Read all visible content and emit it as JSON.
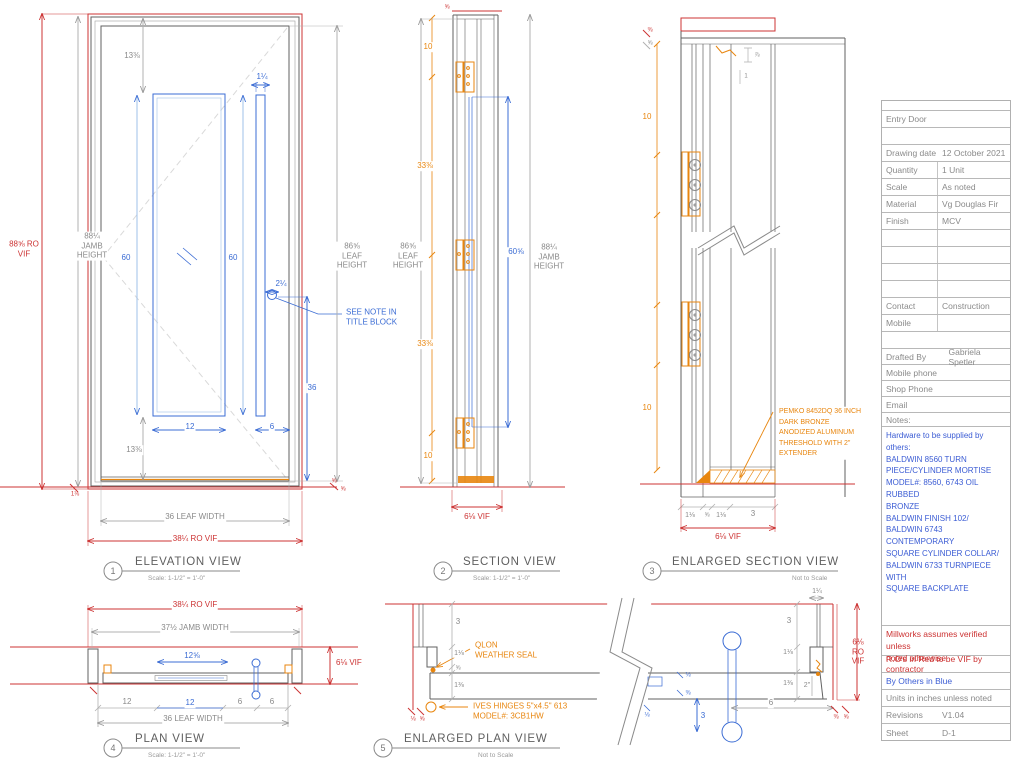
{
  "colors": {
    "red": "#cc3333",
    "blue": "#3b6cd4",
    "orange": "#e8860f",
    "gray": "#8a8a8a",
    "line": "#606060"
  },
  "views": {
    "elevation": {
      "number": "1",
      "title": "ELEVATION VIEW",
      "scale": "Scale: 1-1/2\" = 1'-0\"",
      "dims": {
        "ro_height": "88⅝ RO\nVIF",
        "jamb_height": "88¼\nJAMB\nHEIGHT",
        "glass_top": "13⅜",
        "pull_width": "1¼",
        "glass_height": "60",
        "pull_height": "60",
        "pull_edge": "2¼",
        "pull_bottom": "36",
        "glass_width": "12",
        "pull_gap": "6",
        "glass_bottom": "13⅜",
        "leaf_height": "86⅝\nLEAF\nHEIGHT",
        "leaf_width": "36 LEAF WIDTH",
        "ro_width": "38¼ RO VIF",
        "threshold_left": "1⅛",
        "threshold_right_a": "⅝",
        "threshold_right_b": "⅝"
      },
      "note": "SEE NOTE IN\nTITLE BLOCK"
    },
    "section": {
      "number": "2",
      "title": "SECTION VIEW",
      "scale": "Scale: 1-1/2\" = 1'-0\"",
      "dims": {
        "leaf_height": "86⅝\nLEAF\nHEIGHT",
        "top": "10",
        "upper": "33⅜",
        "lower": "33⅜",
        "bottom": "10",
        "glass": "60⅝",
        "jamb_height": "88¼\nJAMB\nHEIGHT",
        "width_vif": "6⅛ VIF",
        "head": "⅝"
      }
    },
    "enlarged_section": {
      "number": "3",
      "title": "ENLARGED SECTION VIEW",
      "scale": "Not to Scale",
      "dims": {
        "top": "10",
        "bottom": "10",
        "b1": "1⅛",
        "b2": "⅝",
        "b3": "1⅛",
        "b4": "3",
        "width_vif": "6⅛ VIF",
        "tl1": "⅜",
        "tl2": "⅝",
        "tr1": "⅞",
        "tr2": "1"
      },
      "note": "PEMKO 8452DQ 36 INCH\nDARK BRONZE\nANODIZED ALUMINUM\nTHRESHOLD WITH 2\"\nEXTENDER"
    },
    "plan": {
      "number": "4",
      "title": "PLAN VIEW",
      "scale": "Scale: 1-1/2\" = 1'-0\"",
      "dims": {
        "ro_width": "38¼ RO VIF",
        "jamb_width": "37½ JAMB WIDTH",
        "glass": "12⅝",
        "depth_vif": "6⅛ VIF",
        "left": "12",
        "glass_b": "12",
        "gap_a": "6",
        "gap_b": "6",
        "leaf_width": "36 LEAF WIDTH"
      }
    },
    "enlarged_plan": {
      "number": "5",
      "title": "ENLARGED PLAN VIEW",
      "scale": "Not to Scale",
      "dims": {
        "l_wall": "3",
        "l_jamb": "1⅛",
        "l_gap": "⅝",
        "l_leaf": "1⅜",
        "pull_center": "3",
        "r_jamb_w": "1¼",
        "r_wall": "3",
        "r_jamb": "1⅛",
        "r_leaf": "1⅜",
        "r_2in": "2\"",
        "pull_off": "6",
        "ro_depth": "6⅛\nRO\nVIF",
        "tl_a": "⅛",
        "tl_b": "⅝",
        "tm_a": "⅛",
        "tm_b": "⅜",
        "tb_a": "⅛",
        "tr_a": "⅜",
        "tr_b": "⅝"
      },
      "notes": {
        "seal": "QLON\nWEATHER SEAL",
        "hinge": "IVES HINGES 5\"x4.5\" 613\nMODEL#: 3CB1HW"
      }
    }
  },
  "title_block": {
    "project": "Entry Door",
    "rows": [
      {
        "label": "Drawing date",
        "value": "12 October 2021"
      },
      {
        "label": "Quantity",
        "value": "1 Unit"
      },
      {
        "label": "Scale",
        "value": "As noted"
      },
      {
        "label": "Material",
        "value": "Vg Douglas Fir"
      },
      {
        "label": "Finish",
        "value": "MCV"
      }
    ],
    "contact_label": "Contact",
    "contact_value": "Construction",
    "mobile_label": "Mobile",
    "drafted_label": "Drafted By",
    "drafted_value": "Gabriela Spetler",
    "mobile_phone_label": "Mobile phone",
    "shop_phone_label": "Shop Phone",
    "email_label": "Email",
    "notes_label": "Notes:",
    "hardware_note": "Hardware to be supplied by others:\nBALDWIN 8560 TURN\nPIECE/CYLINDER MORTISE\nMODEL#: 8560, 6743 OIL RUBBED\nBRONZE\nBALDWIN FINISH 102/\nBALDWIN 6743 CONTEMPORARY\nSQUARE CYLINDER COLLAR/\nBALDWIN 6733 TURNPIECE WITH\nSQUARE BACKPLATE",
    "disclaimer": "Millworks assumes verified unless\nnoted otherwise",
    "ro_note": "R.O's in Red to be VIF by contractor",
    "blue_note": "By Others in Blue",
    "units_note": "Units in inches unless noted",
    "revisions_label": "Revisions",
    "revisions_value": "V1.04",
    "sheet_label": "Sheet",
    "sheet_value": "D-1"
  }
}
